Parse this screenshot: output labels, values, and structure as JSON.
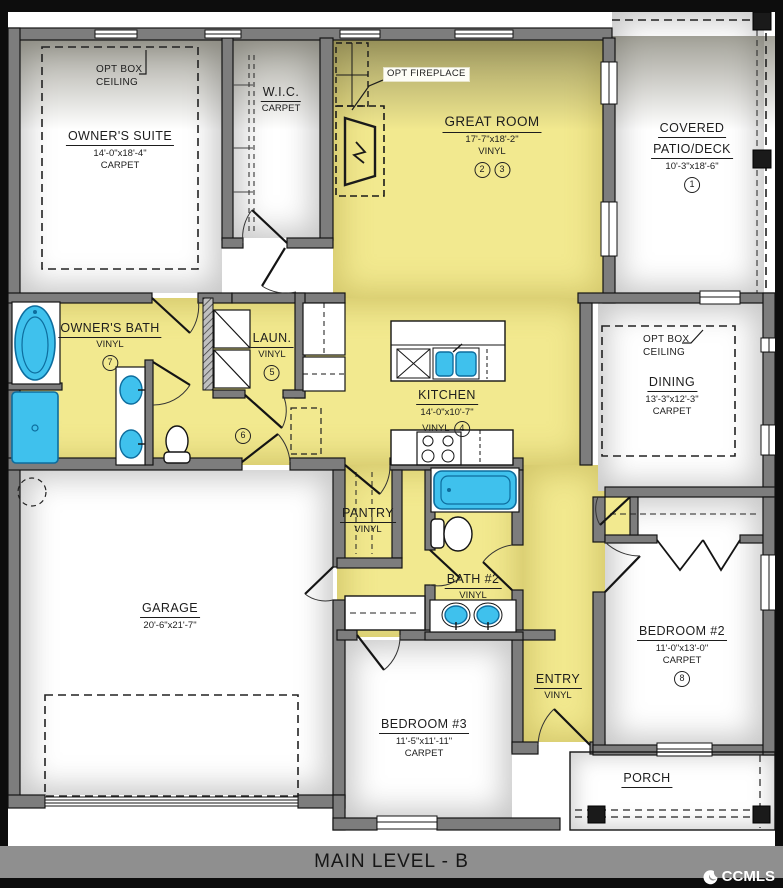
{
  "title_bar": {
    "label": "MAIN LEVEL - B",
    "watermark": "CCMLS"
  },
  "annotations": {
    "opt_box_ceiling_suite": {
      "line1": "OPT BOX",
      "line2": "CEILING"
    },
    "opt_fireplace": "OPT FIREPLACE",
    "opt_box_ceiling_dining": {
      "line1": "OPT BOX",
      "line2": "CEILING"
    }
  },
  "rooms": {
    "owners_suite": {
      "name": "OWNER'S SUITE",
      "dims": "14'-0\"x18'-4\"",
      "floor": "CARPET"
    },
    "wic": {
      "name": "W.I.C.",
      "floor": "CARPET"
    },
    "great_room": {
      "name": "GREAT ROOM",
      "dims": "17'-7\"x18'-2\"",
      "floor": "VINYL",
      "markers": [
        "2",
        "3"
      ]
    },
    "covered_patio": {
      "name1": "COVERED",
      "name2": "PATIO/DECK",
      "dims": "10'-3\"x18'-6\"",
      "marker": "1"
    },
    "owners_bath": {
      "name": "OWNER'S BATH",
      "floor": "VINYL",
      "marker": "7"
    },
    "laundry": {
      "name": "LAUN.",
      "floor": "VINYL",
      "marker": "5"
    },
    "hall": {
      "marker": "6"
    },
    "kitchen": {
      "name": "KITCHEN",
      "dims": "14'-0\"x10'-7\"",
      "floor": "VINYL",
      "marker": "4"
    },
    "dining": {
      "name": "DINING",
      "dims": "13'-3\"x12'-3\"",
      "floor": "CARPET"
    },
    "pantry": {
      "name": "PANTRY",
      "floor": "VINYL"
    },
    "bath2": {
      "name": "BATH #2",
      "floor": "VINYL"
    },
    "garage": {
      "name": "GARAGE",
      "dims": "20'-6\"x21'-7\""
    },
    "bedroom2": {
      "name": "BEDROOM #2",
      "dims": "11'-0\"x13'-0\"",
      "floor": "CARPET",
      "marker": "8"
    },
    "bedroom3": {
      "name": "BEDROOM #3",
      "dims": "11'-5\"x11'-11\"",
      "floor": "CARPET"
    },
    "entry": {
      "name": "ENTRY",
      "floor": "VINYL"
    },
    "porch": {
      "name": "PORCH"
    }
  },
  "colors": {
    "floor_yellow": "#f2e98f",
    "fixture_blue": "#3fc1ed",
    "wall_gray": "#7d7d7d",
    "bar_gray": "#8f8f8f"
  }
}
